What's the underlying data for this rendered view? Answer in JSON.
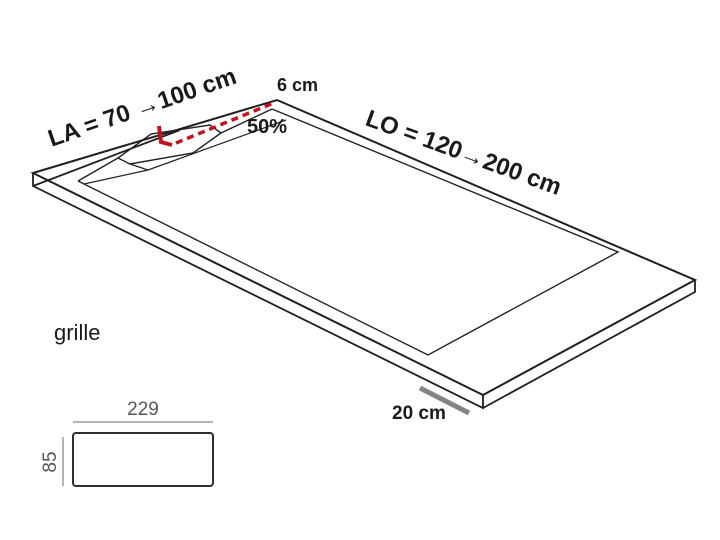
{
  "labels": {
    "la": "LA = 70 →100 cm",
    "lo": "LO = 120→200 cm",
    "edge_width": "6 cm",
    "slope": "50%",
    "grille": "grille",
    "corner_length": "20 cm"
  },
  "grille_dimensions": {
    "width": "229",
    "height": "85"
  },
  "colors": {
    "accent_red": "#c1121f",
    "measure_gray": "#848484",
    "dim_line_gray": "#9b9b9b"
  }
}
